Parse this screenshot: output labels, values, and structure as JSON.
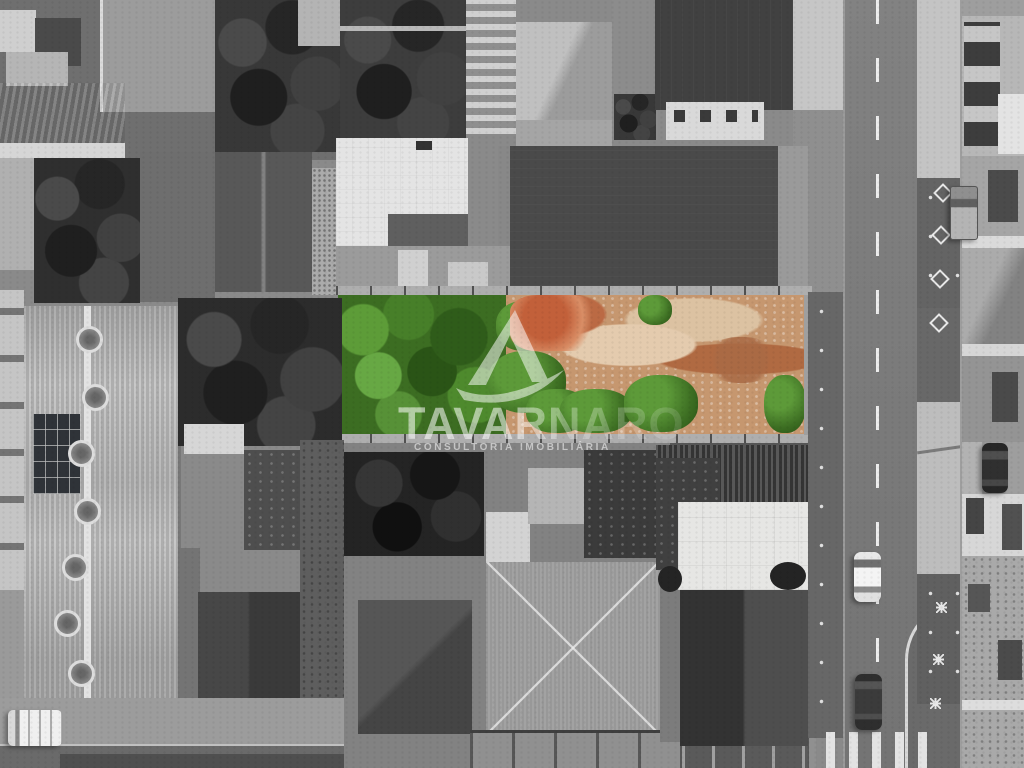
{
  "scene": {
    "type": "aerial-drone-photo",
    "description": "Top-down drone photograph of a city block, desaturated to grayscale except the advertised vacant lot shown in full color (green tree canopy on the left, exposed orange soil with weeds on the right)",
    "lot": {
      "name": "highlighted vacant lot",
      "tree_color": "#3c6d22",
      "soil_color": "#c6976f",
      "rubble_color": "#bb6a44"
    },
    "watermark": {
      "brand": "TAVARNARO",
      "tagline": "CONSULTORIA IMOBILIÁRIA",
      "logo": "sail-monogram",
      "color": "#ffffff"
    },
    "street": {
      "surface_color": "#7b7b7b",
      "marking": "dashed white center line",
      "crosswalk": "zebra stripes",
      "sidewalk_marks": "white diamonds and stars"
    },
    "vehicles": {
      "white_car": "#f2f2f2",
      "dark_car": "#3a3a3a",
      "pickup_truck": "#9c9c9c",
      "parked_dark_car": "#2f2f2f",
      "white_van": "#f5f5f5"
    }
  }
}
